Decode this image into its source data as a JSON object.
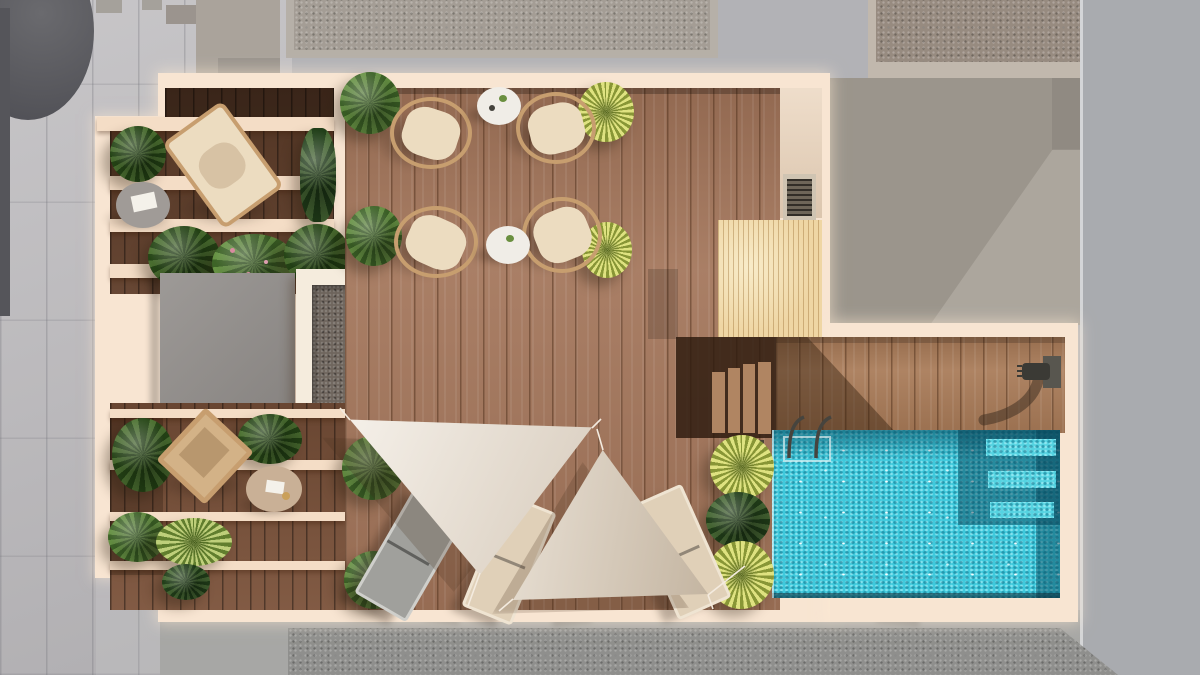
{
  "scene": {
    "kind": "architectural aerial render",
    "subject": "rooftop terrace with swimming pool, top-down view",
    "text_content": "none (image contains no text)"
  },
  "palette": {
    "bg": "#b2b2b6",
    "pavement": "#bdbbbe",
    "pavement_right": "#a9abaf",
    "dark_structure": "#55555a",
    "roof_a": "#aaa39b",
    "roof_frame": "#b6b0a8",
    "roof_top_b": "#a49d95",
    "roof_top_c": "#978b80",
    "roof_right": "#9b958c",
    "roof_right_light": "#aca69d",
    "bottom_light": "#a7a7a5",
    "bottom_dark": "#8f8f8d",
    "terrace": "#f8e5d2",
    "slat": "#f4ddc6",
    "wood_dark": "#5f3d29",
    "wood_mid": "#7b523a",
    "wood_main": "#a3755a",
    "wood_pool_deck": "#a87a57",
    "stair_dark": "rgba(44,26,13,0.82)",
    "stair_tread": "#b08562",
    "gravel": "#6f665e",
    "gravel_frame": "#f5ecdd",
    "block_gray": "#928e8b",
    "pine": "#efd6a4",
    "utility_panel": "#e9d2b9",
    "grate": "#6e6659",
    "grate_frame": "#cfc4b2",
    "pool_water": "#3ec9dc",
    "pool_deep": "rgba(8,76,96,0.5)",
    "pool_step": "#55d3e1",
    "sail_light": "#ece3d6",
    "sail_dark": "#dccfbd",
    "sail_shadow": "rgba(70,45,28,0.22)",
    "rope": "#f4ebdf",
    "rattan": "#c79e6f",
    "cushion": "#ecdcc0",
    "table_white": "#f0ede7",
    "table_gray": "#a09b97",
    "mat_round": "#c9b096",
    "lounger_gray": "#a0a09c",
    "lounger_beige": "#e0d0b8",
    "lounge_wood": "#d3b287",
    "bush": "#557f36",
    "bush_dark": "#34561f",
    "palm": "#b7bf4e",
    "palm_green": "#6f9440",
    "fern": "#2f4d24",
    "planter_box": "#4a4336",
    "metal": "#46443e",
    "book_white": "#f4f1ea"
  },
  "inventory": {
    "seating_area": {
      "round_rattan_chairs": 4,
      "round_coffee_tables": 2
    },
    "pergola_lounge": {
      "hanging_chairs": 1,
      "side_tables": 1,
      "pergola_slat_rows": 4
    },
    "lower_terrace": {
      "wooden_daybeds": 1,
      "round_mats": 1,
      "pergola_slat_rows": 4
    },
    "sun_deck": {
      "sun_loungers": 3,
      "shade_sails": 2
    },
    "pool": {
      "ladders": 1,
      "submerged_steps": 3,
      "outdoor_showers": 1
    },
    "roof_features": {
      "gravel_panels": 1,
      "gray_roof_blocks": 1,
      "timber_platforms": 1,
      "shower_trays": 1,
      "drain_grates": 1
    },
    "plants": {
      "green_bushes": 10,
      "yellow_palms": 6,
      "dark_ferns": 4
    }
  }
}
